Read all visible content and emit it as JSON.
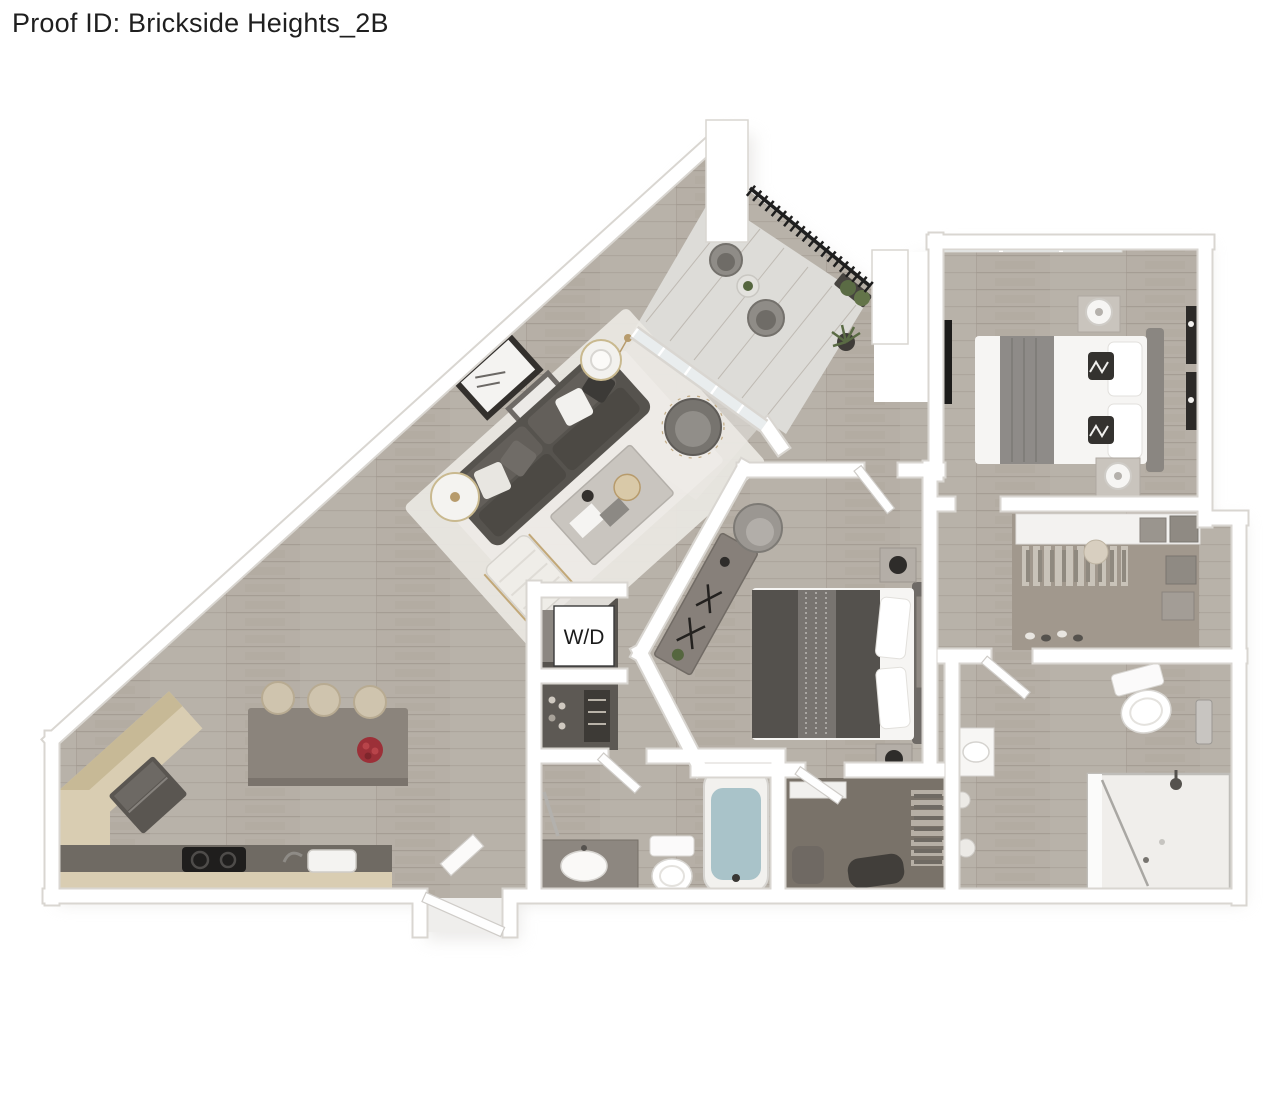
{
  "header": {
    "proof_id": "Proof ID: Brickside Heights_2B"
  },
  "floorplan": {
    "labels": {
      "washer_dryer": "W/D"
    },
    "colors": {
      "wall": "#ffffff",
      "wall_edge": "#d9d6d1",
      "floor_wood": "#b6afa6",
      "floor_balcony": "#dddcd8",
      "floor_closet_dark": "#57534e",
      "floor_walkin": "#a1988d",
      "rug": "#eae8e3",
      "sofa": "#56534e",
      "island": "#8b847c",
      "cabinet_wood": "#d9cdb2",
      "counter_top": "#6f6a63",
      "bed_duvet_dark": "#54514d",
      "bed_white": "#f6f5f3",
      "accent_gold": "#b79b6c",
      "railing": "#1f1f1f",
      "plant": "#55663f",
      "water": "#a9c3c9",
      "fruit": "#9c3038",
      "window_glass": "#e9edee"
    }
  }
}
